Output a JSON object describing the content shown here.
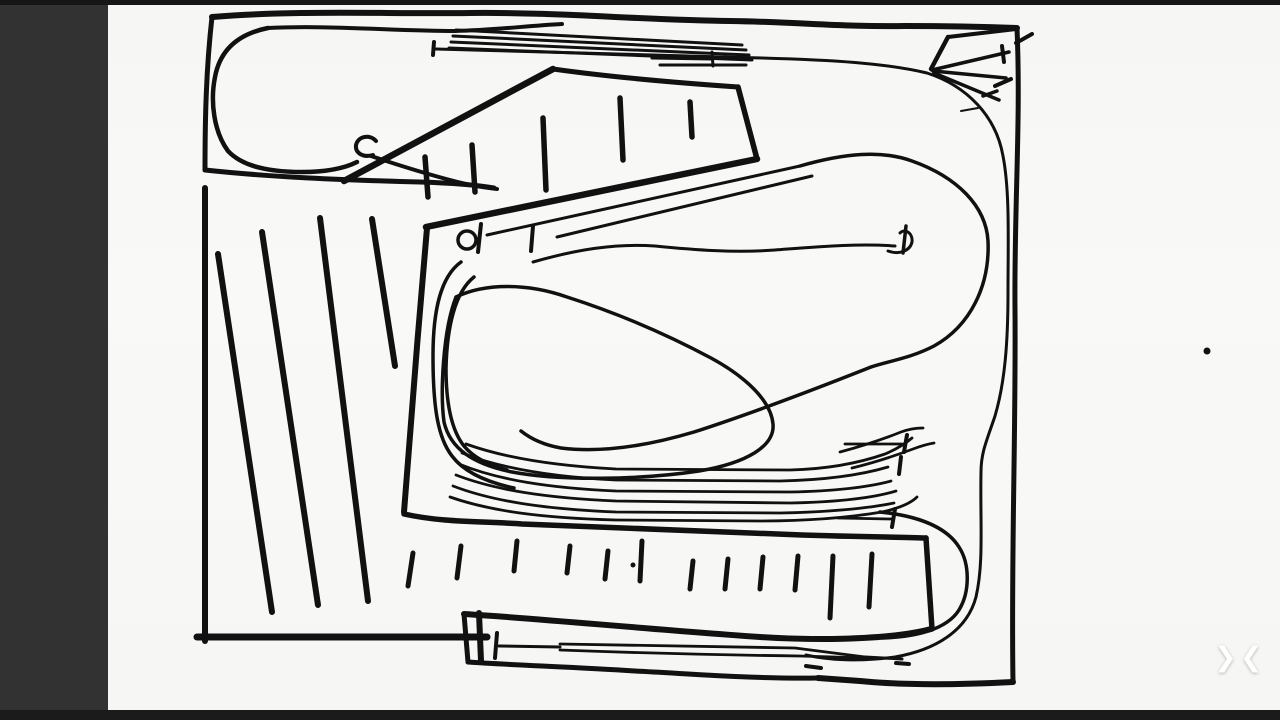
{
  "window": {
    "width": 1280,
    "height": 720,
    "app_kind": "whiteboard-sketch-viewer"
  },
  "theme": {
    "panel_bg": "#323232",
    "top_strip_bg": "#161616",
    "bottom_strip_bg": "#1b1b1b",
    "canvas_bg": "#f7f7f5",
    "ink": "#111111",
    "chevron_color": "#ffffff"
  },
  "viewer": {
    "chevron_collapse_right": "❯",
    "chevron_collapse_left": "❮"
  },
  "sketch": {
    "description": "Hand-drawn black-ink track-plan style sketch: bordered frame, top-left loop with curl hook, hatched left area, angled platform with tick marks, multi-line yards, large pear-shaped loop with bumper markers, bottom yard box with ladder ticks and U-turn loop",
    "ink": "#111111",
    "strokes": [
      {
        "d": "M212,17 C300,10 380,14 470,13 C560,12 640,20 730,21 C800,22 840,27 905,26 C950,26 990,27 1017,28",
        "w": 6
      },
      {
        "d": "M1017,28 C1021,120 1014,210 1015,310 C1016,430 1011,560 1013,682",
        "w": 5
      },
      {
        "d": "M1016,43 L1032,34",
        "w": 4
      },
      {
        "d": "M1013,682 C955,685 900,685 860,681 L818,678",
        "w": 6
      },
      {
        "d": "M818,678 C755,679 695,674 635,671 C575,667 510,665 468,662",
        "w": 5
      },
      {
        "d": "M468,662 L464,614",
        "w": 5
      },
      {
        "d": "M464,614 C545,619 645,629 760,637 C840,642 902,637 931,629",
        "w": 6
      },
      {
        "d": "M212,17 C206,70 205,120 205,170",
        "w": 5
      },
      {
        "d": "M205,170 C270,177 340,180 420,182 C452,183 477,185 494,188",
        "w": 5
      },
      {
        "d": "M205,188 L205,641",
        "w": 6
      },
      {
        "d": "M197,637 L487,637",
        "w": 7
      },
      {
        "d": "M479,613 L481,661",
        "w": 6
      },
      {
        "d": "M218,254 L272,612",
        "w": 6
      },
      {
        "d": "M262,232 L318,605",
        "w": 6
      },
      {
        "d": "M320,218 L368,601",
        "w": 6
      },
      {
        "d": "M372,219 L395,366",
        "w": 6
      },
      {
        "d": "M268,28 C238,34 220,50 215,77 C210,102 214,132 228,151 C243,167 270,172 302,172 C325,172 343,169 357,162",
        "w": 4.5
      },
      {
        "d": "M268,28 C330,25 395,31 455,31 C495,30 525,26 562,24",
        "w": 4
      },
      {
        "d": "M376,141 C370,134 358,136 356,145 C355,153 363,158 373,155",
        "w": 4
      },
      {
        "d": "M371,156 C395,164 432,176 466,184 C480,187 489,188 497,189",
        "w": 4
      },
      {
        "d": "M456,30 L742,45",
        "w": 3
      },
      {
        "d": "M453,36 L746,50",
        "w": 3
      },
      {
        "d": "M451,42 L749,55",
        "w": 3
      },
      {
        "d": "M449,48 L752,60",
        "w": 3
      },
      {
        "d": "M434,42 L433,55",
        "w": 4
      },
      {
        "d": "M436,49 C560,53 660,55 762,58 C832,60 885,63 927,73 C967,86 996,116 1003,156 C1010,192 1008,242 1008,292 C1008,342 1005,382 995,416 C987,440 981,452 981,472 C980,522 984,562 976,597 C967,631 935,650 895,657 C860,662 828,660 806,655",
        "w": 3
      },
      {
        "d": "M652,58 L712,59",
        "w": 3
      },
      {
        "d": "M660,65 L746,65",
        "w": 3
      },
      {
        "d": "M712,52 L713,66",
        "w": 3
      },
      {
        "d": "M948,37 L1016,29",
        "w": 4
      },
      {
        "d": "M948,37 L931,69",
        "w": 4.5
      },
      {
        "d": "M932,70 L1009,52",
        "w": 3.5
      },
      {
        "d": "M933,71 L1006,78",
        "w": 3.5
      },
      {
        "d": "M934,73 L999,100",
        "w": 3.5
      },
      {
        "d": "M1002,46 L1004,62",
        "w": 4
      },
      {
        "d": "M995,86 L1011,79",
        "w": 4
      },
      {
        "d": "M983,96 L997,91",
        "w": 3.5
      },
      {
        "d": "M961,111 L978,108",
        "w": 2
      },
      {
        "d": "M344,181 L553,69",
        "w": 6.5
      },
      {
        "d": "M553,69 C610,77 680,83 738,87",
        "w": 5
      },
      {
        "d": "M738,87 L757,159",
        "w": 5.5
      },
      {
        "d": "M757,159 C650,181 540,203 426,227",
        "w": 6.5
      },
      {
        "d": "M427,228 C419,320 410,430 404,512",
        "w": 6
      },
      {
        "d": "M404,514 C445,523 482,521 522,524 C622,528 722,532 802,535 C862,537 902,537 926,538",
        "w": 5.5
      },
      {
        "d": "M926,538 L932,629",
        "w": 5.5
      },
      {
        "d": "M425,157 L428,197",
        "w": 5.5
      },
      {
        "d": "M472,145 L475,192",
        "w": 5.5
      },
      {
        "d": "M543,118 L546,190",
        "w": 5.5
      },
      {
        "d": "M620,98 L623,160",
        "w": 5.5
      },
      {
        "d": "M690,102 L692,137",
        "w": 5.5
      },
      {
        "d": "M487,235 L800,166",
        "w": 3
      },
      {
        "d": "M557,237 L812,176",
        "w": 3
      },
      {
        "d": "M481,224 L478,252",
        "w": 4
      },
      {
        "d": "M533,226 L531,251",
        "w": 4
      },
      {
        "d": "M800,166 C845,153 882,150 912,161 C957,177 986,206 988,241 C990,286 970,326 934,346 C911,358 889,361 871,367",
        "w": 3.5
      },
      {
        "d": "M871,367 C818,388 753,413 694,432 C647,446 601,453 561,448 C544,445 531,439 521,431",
        "w": 3.5
      },
      {
        "d": "M533,262 C575,250 615,243 655,246 C695,250 735,253 775,250 C815,247 858,243 895,246",
        "w": 3
      },
      {
        "d": "M888,251 C899,255 910,251 912,242 C913,233 905,228 900,233",
        "w": 3
      },
      {
        "d": "M906,226 L903,253",
        "w": 3.5
      },
      {
        "d": "M456,297 C485,283 527,283 567,297 C617,313 668,335 711,358 C746,377 771,401 773,424 C775,446 747,463 699,471 C639,480 560,481 512,472 C472,464 450,448 444,422 C440,392 443,330 456,297",
        "w": 3.5
      },
      {
        "d": "M461,262 C440,277 433,312 433,356 C433,408 438,438 452,456 C464,472 486,482 514,488",
        "w": 3.5
      },
      {
        "d": "M474,277 C455,292 447,327 446,368 C446,406 452,431 464,446 C473,457 488,465 507,470",
        "w": 3.5
      },
      {
        "d": "M466,444 C505,458 556,466 616,469 L790,470 C830,469 862,462 885,454 C897,449 906,443 912,438",
        "w": 2.8
      },
      {
        "d": "M462,453 C500,468 551,477 616,480 L780,481 C825,480 861,475 888,467",
        "w": 2.8
      },
      {
        "d": "M459,464 C498,480 549,488 616,491 L790,492 C835,491 869,487 891,481",
        "w": 2.8
      },
      {
        "d": "M456,475 C495,490 546,498 616,501 L790,503 C839,502 873,498 896,491",
        "w": 2.8
      },
      {
        "d": "M453,486 C492,501 543,509 616,512 L780,513 C831,512 869,508 894,503",
        "w": 2.8
      },
      {
        "d": "M450,497 C490,511 541,518 616,520 L760,521 C812,521 852,517 882,512 C900,508 911,503 917,497",
        "w": 2.8
      },
      {
        "d": "M840,452 C866,445 886,438 901,432 C909,429 916,428 923,428",
        "w": 2.8
      },
      {
        "d": "M852,468 C877,462 897,455 913,449 C921,446 928,444 934,443",
        "w": 2.8
      },
      {
        "d": "M845,444 L902,444",
        "w": 2.8
      },
      {
        "d": "M907,435 L904,452",
        "w": 4
      },
      {
        "d": "M901,457 L899,474",
        "w": 4
      },
      {
        "d": "M838,518 L892,519",
        "w": 2.8
      },
      {
        "d": "M895,509 L892,527",
        "w": 4
      },
      {
        "d": "M880,512 C920,516 947,528 959,547 C970,564 970,592 959,610 C947,629 917,637 882,638",
        "w": 3.5
      },
      {
        "d": "M413,553 L408,586",
        "w": 5
      },
      {
        "d": "M461,546 L457,578",
        "w": 5
      },
      {
        "d": "M517,541 L514,571",
        "w": 5
      },
      {
        "d": "M570,546 L567,573",
        "w": 5
      },
      {
        "d": "M608,551 L605,579",
        "w": 5
      },
      {
        "d": "M642,541 L640,581",
        "w": 5
      },
      {
        "d": "M693,561 L690,589",
        "w": 5
      },
      {
        "d": "M728,559 L725,589",
        "w": 5
      },
      {
        "d": "M763,557 L760,589",
        "w": 5
      },
      {
        "d": "M798,556 L795,590",
        "w": 5
      },
      {
        "d": "M833,556 L830,618",
        "w": 5
      },
      {
        "d": "M872,554 L869,607",
        "w": 5
      },
      {
        "d": "M497,633 L495,658",
        "w": 4
      },
      {
        "d": "M499,646 L560,647",
        "w": 3
      },
      {
        "d": "M560,644 L795,648 L865,657",
        "w": 2.8
      },
      {
        "d": "M560,650 C640,653 720,655 800,656 L868,658",
        "w": 2.8
      },
      {
        "d": "M865,657 L902,659",
        "w": 3
      },
      {
        "d": "M806,666 L821,668",
        "w": 4
      },
      {
        "d": "M896,663 L909,664",
        "w": 4
      }
    ],
    "circles": [
      {
        "cx": 467,
        "cy": 240,
        "r": 9,
        "w": 3.5
      }
    ],
    "dots": [
      {
        "cx": 633,
        "cy": 565,
        "r": 2.5
      },
      {
        "cx": 1207,
        "cy": 351,
        "r": 3.5
      }
    ]
  }
}
